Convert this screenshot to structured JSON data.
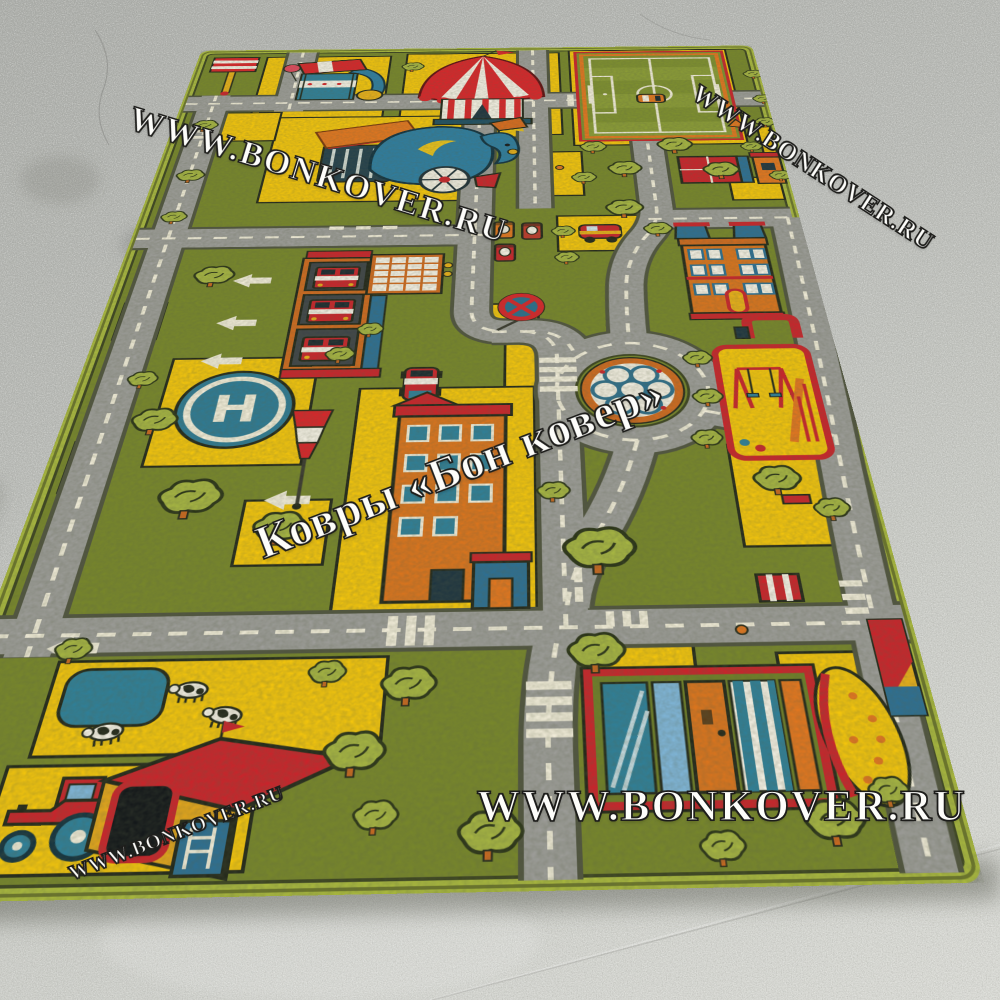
{
  "scene": {
    "subject": "children's toy-town road play rug photographed on a gray concrete floor"
  },
  "watermarks": {
    "top_left": "WWW.BONKOVER.RU",
    "top_right": "WWW.BONKOVER.RU",
    "center": "Ковры «Бон ковер»",
    "bottom": "WWW.BONKOVER.RU",
    "bottom_left": "WWW.BONKOVER.RU"
  },
  "rug": {
    "helipad_letter": "H",
    "colors": {
      "binding": "#a9b83e",
      "base_green": "#77862b",
      "tree_green": "#a5b442",
      "road_gray": "#9c9c98",
      "marking_cream": "#f1ecd9",
      "field_yellow": "#f2c40d",
      "red": "#c9242b",
      "orange": "#e2761f",
      "teal": "#2f7f98",
      "navy": "#1f4f63"
    },
    "features": [
      "football-pitch",
      "circus-tent",
      "carousel",
      "peacock-train-ride",
      "striped-awning-pole",
      "gas-station-pumps",
      "no-stopping-sign",
      "fire-station",
      "left-turn-arrows",
      "helipad",
      "windsock",
      "apartment-building",
      "parked-cars",
      "roundabout-wheel",
      "cottages",
      "school",
      "red-gate",
      "playground",
      "striped-bench",
      "market-stall",
      "dotted-awning",
      "corner-kiosk",
      "farm-field",
      "pond",
      "cows",
      "tractor",
      "barn",
      "zebra-crossings",
      "trees-and-bushes"
    ]
  },
  "floor": {
    "base": "#c2c4bf"
  }
}
